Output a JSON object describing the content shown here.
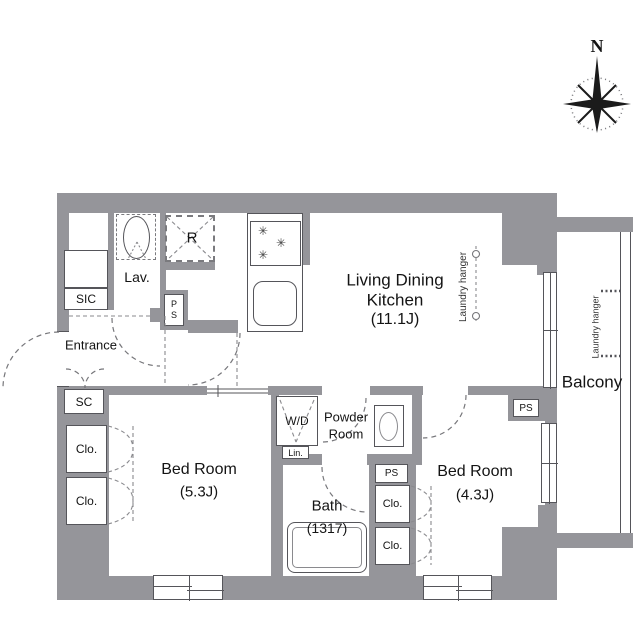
{
  "compass": {
    "north": "N"
  },
  "rooms": {
    "ldk": {
      "name1": "Living Dining",
      "name2": "Kitchen",
      "size": "(11.1J)"
    },
    "bedroom_main": {
      "name": "Bed Room",
      "size": "(5.3J)"
    },
    "bedroom_second": {
      "name": "Bed Room",
      "size": "(4.3J)"
    },
    "bath": {
      "name": "Bath",
      "size": "(1317)"
    },
    "powder": {
      "name1": "Powder",
      "name2": "Room"
    },
    "lav": {
      "name": "Lav."
    },
    "entrance": {
      "name": "Entrance"
    },
    "balcony": {
      "name": "Balcony"
    }
  },
  "fixtures": {
    "refrigerator": "R",
    "washer_dryer": "W/D",
    "linen": "Lin.",
    "shoe_in_closet": "SIC",
    "storage_closet": "SC",
    "closet": "Clo.",
    "pipe_space": "PS",
    "laundry_hanger": "Laundry hanger"
  }
}
